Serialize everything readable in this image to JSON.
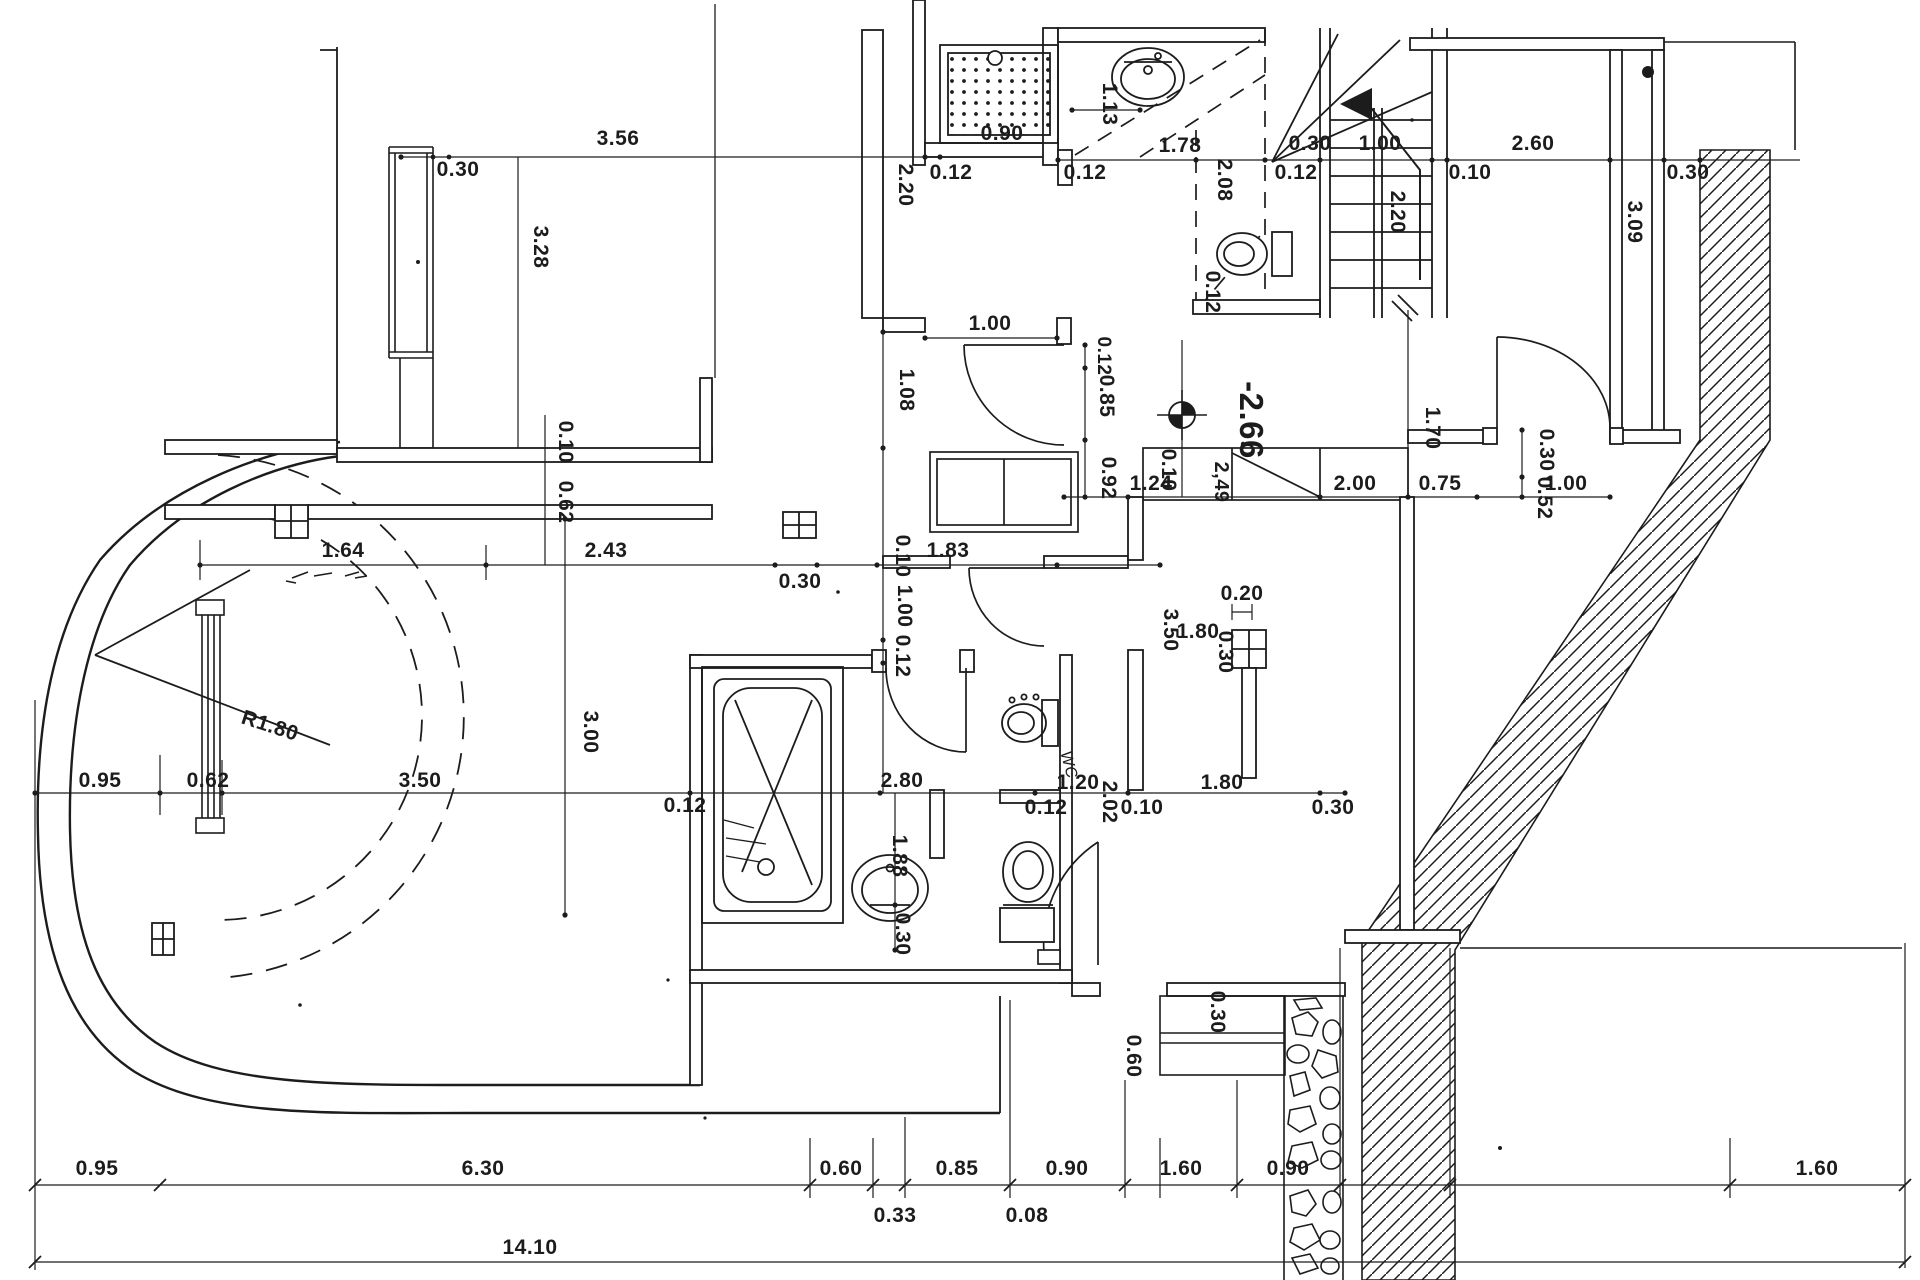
{
  "drawing": {
    "kind": "architectural floor plan, scanned blueprint",
    "ink_color": "#1c1c1c",
    "paper_color": "#ffffff",
    "level_marker": {
      "elevation": "-2.66",
      "secondary": "2,49"
    },
    "radius_label": "R1.80",
    "room_fixture_label": "WC",
    "total_width_label": "14.10"
  },
  "dims": [
    "3.56",
    "0.30",
    "3.28",
    "2.20",
    "0.12",
    "0.90",
    "1.13",
    "0.12",
    "1.78",
    "2.08",
    "0.12",
    "0.30",
    "1.00",
    "0.10",
    "2.20",
    "2.60",
    "0.30",
    "3.09",
    "1.00",
    "1.08",
    "0.12",
    "0.85",
    "0.92",
    "1.24",
    "2.00",
    "0.75",
    "1.70",
    "0.30",
    "0.52",
    "1.00",
    "0.12",
    "0.10",
    "0.62",
    "1.64",
    "2.43",
    "0.30",
    "0.10",
    "1.83",
    "1.00",
    "0.12",
    "3.00",
    "0.95",
    "0.62",
    "3.50",
    "0.12",
    "2.80",
    "1.88",
    "0.30",
    "0.12",
    "1.20",
    "2.02",
    "0.10",
    "1.80",
    "0.30",
    "0.10",
    "3.50",
    "1.80",
    "0.20",
    "0.30",
    "0.30",
    "0.60",
    "0.95",
    "6.30",
    "0.60",
    "0.33",
    "0.85",
    "0.08",
    "0.90",
    "1.60",
    "0.90",
    "1.60"
  ]
}
